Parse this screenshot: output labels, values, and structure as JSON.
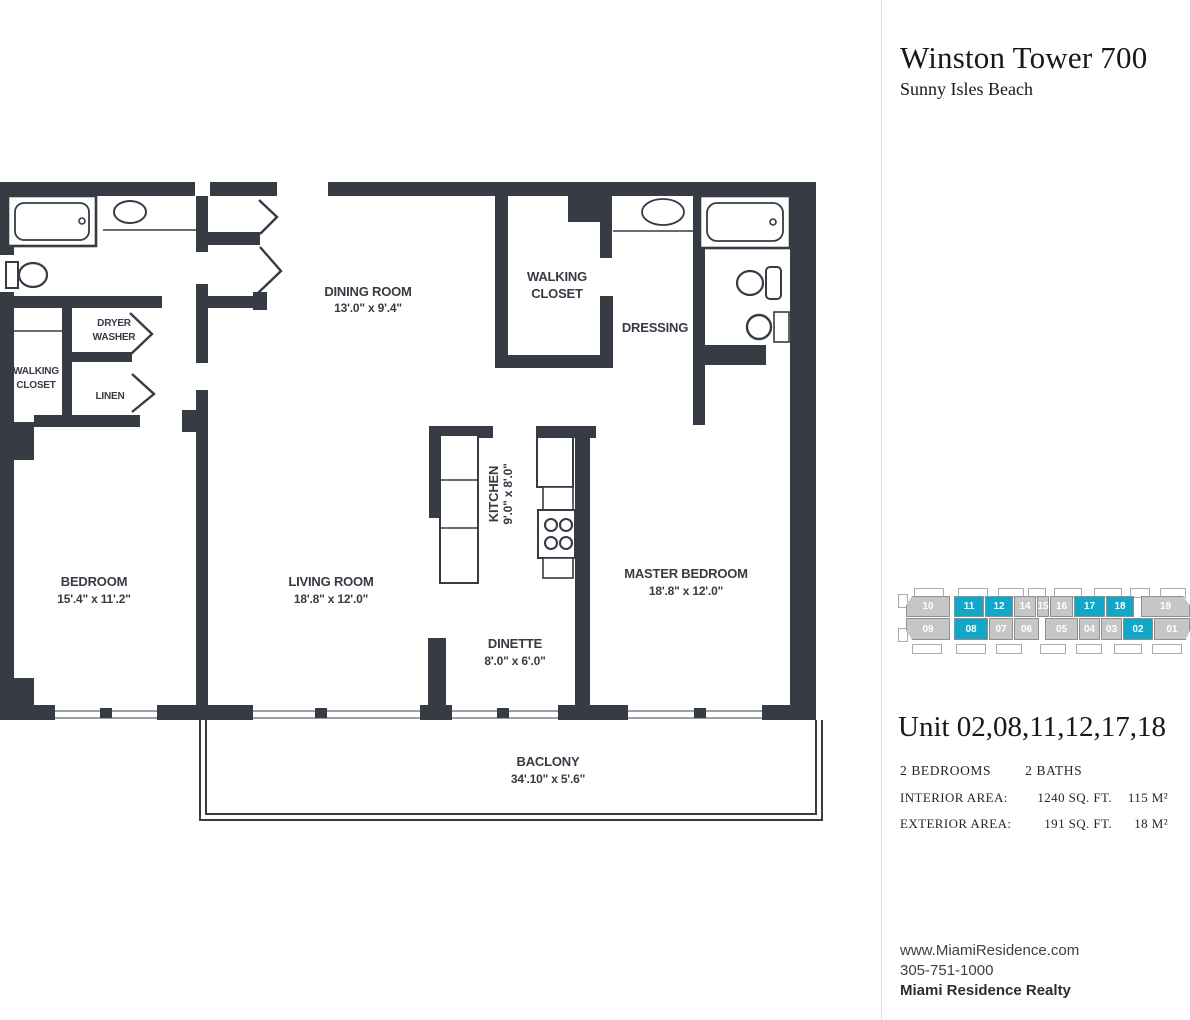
{
  "header": {
    "title": "Winston Tower 700",
    "subtitle": "Sunny Isles Beach"
  },
  "colors": {
    "accent_teal": "#10a7c8",
    "unit_gray": "#c6c6c6",
    "wall": "#363b44"
  },
  "floorplan": {
    "rooms": {
      "bedroom": {
        "name": "BEDROOM",
        "dims": "15'.4\" x 11'.2\""
      },
      "living_room": {
        "name": "LIVING ROOM",
        "dims": "18'.8\" x 12'.0\""
      },
      "dining_room": {
        "name": "DINING ROOM",
        "dims": "13'.0\" x 9'.4\""
      },
      "kitchen": {
        "name": "KITCHEN",
        "dims": "9'.0\" x 8'.0\""
      },
      "dinette": {
        "name": "DINETTE",
        "dims": "8'.0\" x 6'.0\""
      },
      "master_bedroom": {
        "name": "MASTER BEDROOM",
        "dims": "18'.8\" x 12'.0\""
      },
      "balcony": {
        "name": "BACLONY",
        "dims": "34'.10\" x 5'.6\""
      },
      "walking_closet_top": {
        "line1": "WALKING",
        "line2": "CLOSET"
      },
      "walking_closet_left": {
        "line1": "WALKING",
        "line2": "CLOSET"
      },
      "dressing": {
        "name": "DRESSING"
      },
      "dryer_washer": {
        "line1": "DRYER",
        "line2": "WASHER"
      },
      "linen": {
        "name": "LINEN"
      }
    }
  },
  "stack_diagram": {
    "rows": [
      {
        "units": [
          {
            "label": "10",
            "highlighted": false
          },
          {
            "label": "11",
            "highlighted": true
          },
          {
            "label": "12",
            "highlighted": true
          },
          {
            "label": "14",
            "highlighted": false
          },
          {
            "label": "15",
            "highlighted": false
          },
          {
            "label": "16",
            "highlighted": false
          },
          {
            "label": "17",
            "highlighted": true
          },
          {
            "label": "18",
            "highlighted": true
          },
          {
            "label": "19",
            "highlighted": false
          }
        ]
      },
      {
        "units": [
          {
            "label": "09",
            "highlighted": false
          },
          {
            "label": "08",
            "highlighted": true
          },
          {
            "label": "07",
            "highlighted": false
          },
          {
            "label": "06",
            "highlighted": false
          },
          {
            "label": "05",
            "highlighted": false
          },
          {
            "label": "04",
            "highlighted": false
          },
          {
            "label": "03",
            "highlighted": false
          },
          {
            "label": "02",
            "highlighted": true
          },
          {
            "label": "01",
            "highlighted": false
          }
        ]
      }
    ]
  },
  "unit_info": {
    "title": "Unit 02,08,11,12,17,18",
    "bedrooms": "2 BEDROOMS",
    "baths": "2 BATHS",
    "interior_label": "INTERIOR AREA:",
    "interior_sqft": "1240 SQ. FT.",
    "interior_sqm": "115 M²",
    "exterior_label": "EXTERIOR AREA:",
    "exterior_sqft": "191 SQ. FT.",
    "exterior_sqm": "18 M²"
  },
  "contact": {
    "website": "www.MiamiResidence.com",
    "phone": "305-751-1000",
    "company": "Miami Residence Realty"
  }
}
